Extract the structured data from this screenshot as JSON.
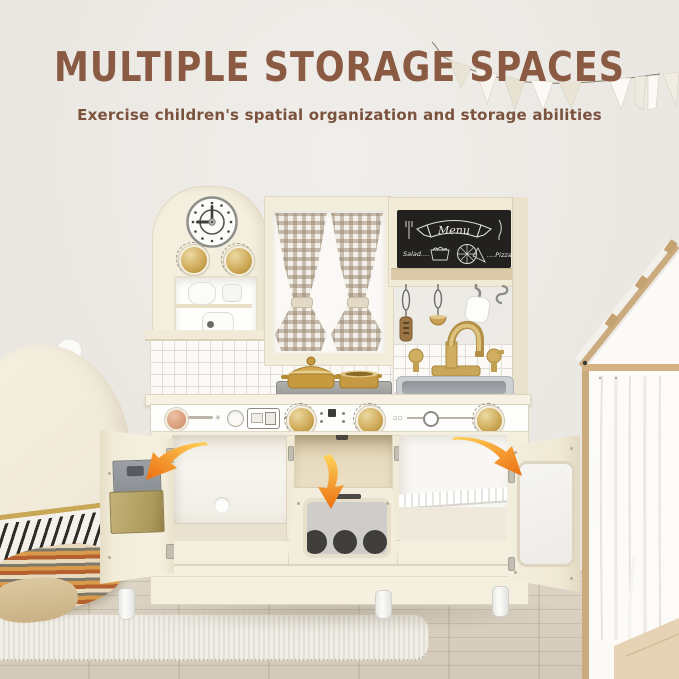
{
  "header": {
    "title": "MULTIPLE STORAGE SPACES",
    "subtitle": "Exercise children's spatial organization and storage abilities"
  },
  "kitchen": {
    "chalkboard": {
      "title": "Menu",
      "left_item": "Salad....",
      "right_item": "....Pizza"
    },
    "clock_time": "9:00",
    "storage_arrows": [
      "left-cabinet",
      "oven",
      "right-cabinet"
    ]
  },
  "colors": {
    "heading_brown": "#8a5a43",
    "arrow_orange": "#ec6f12",
    "arrow_yellow": "#ffd35a",
    "kitchen_cream": "#f3eedd",
    "gold_accent": "#cda855",
    "chalkboard_black": "#22211f",
    "curtain_check": "#97846c",
    "wall": "#edeae6",
    "floor_wood": "#d8cfc0",
    "rug_cream": "#f1eee7",
    "tent_wood": "#cbaa7d",
    "stove_gray": "#a1a19f",
    "sink_silver": "#9ea2a6"
  }
}
